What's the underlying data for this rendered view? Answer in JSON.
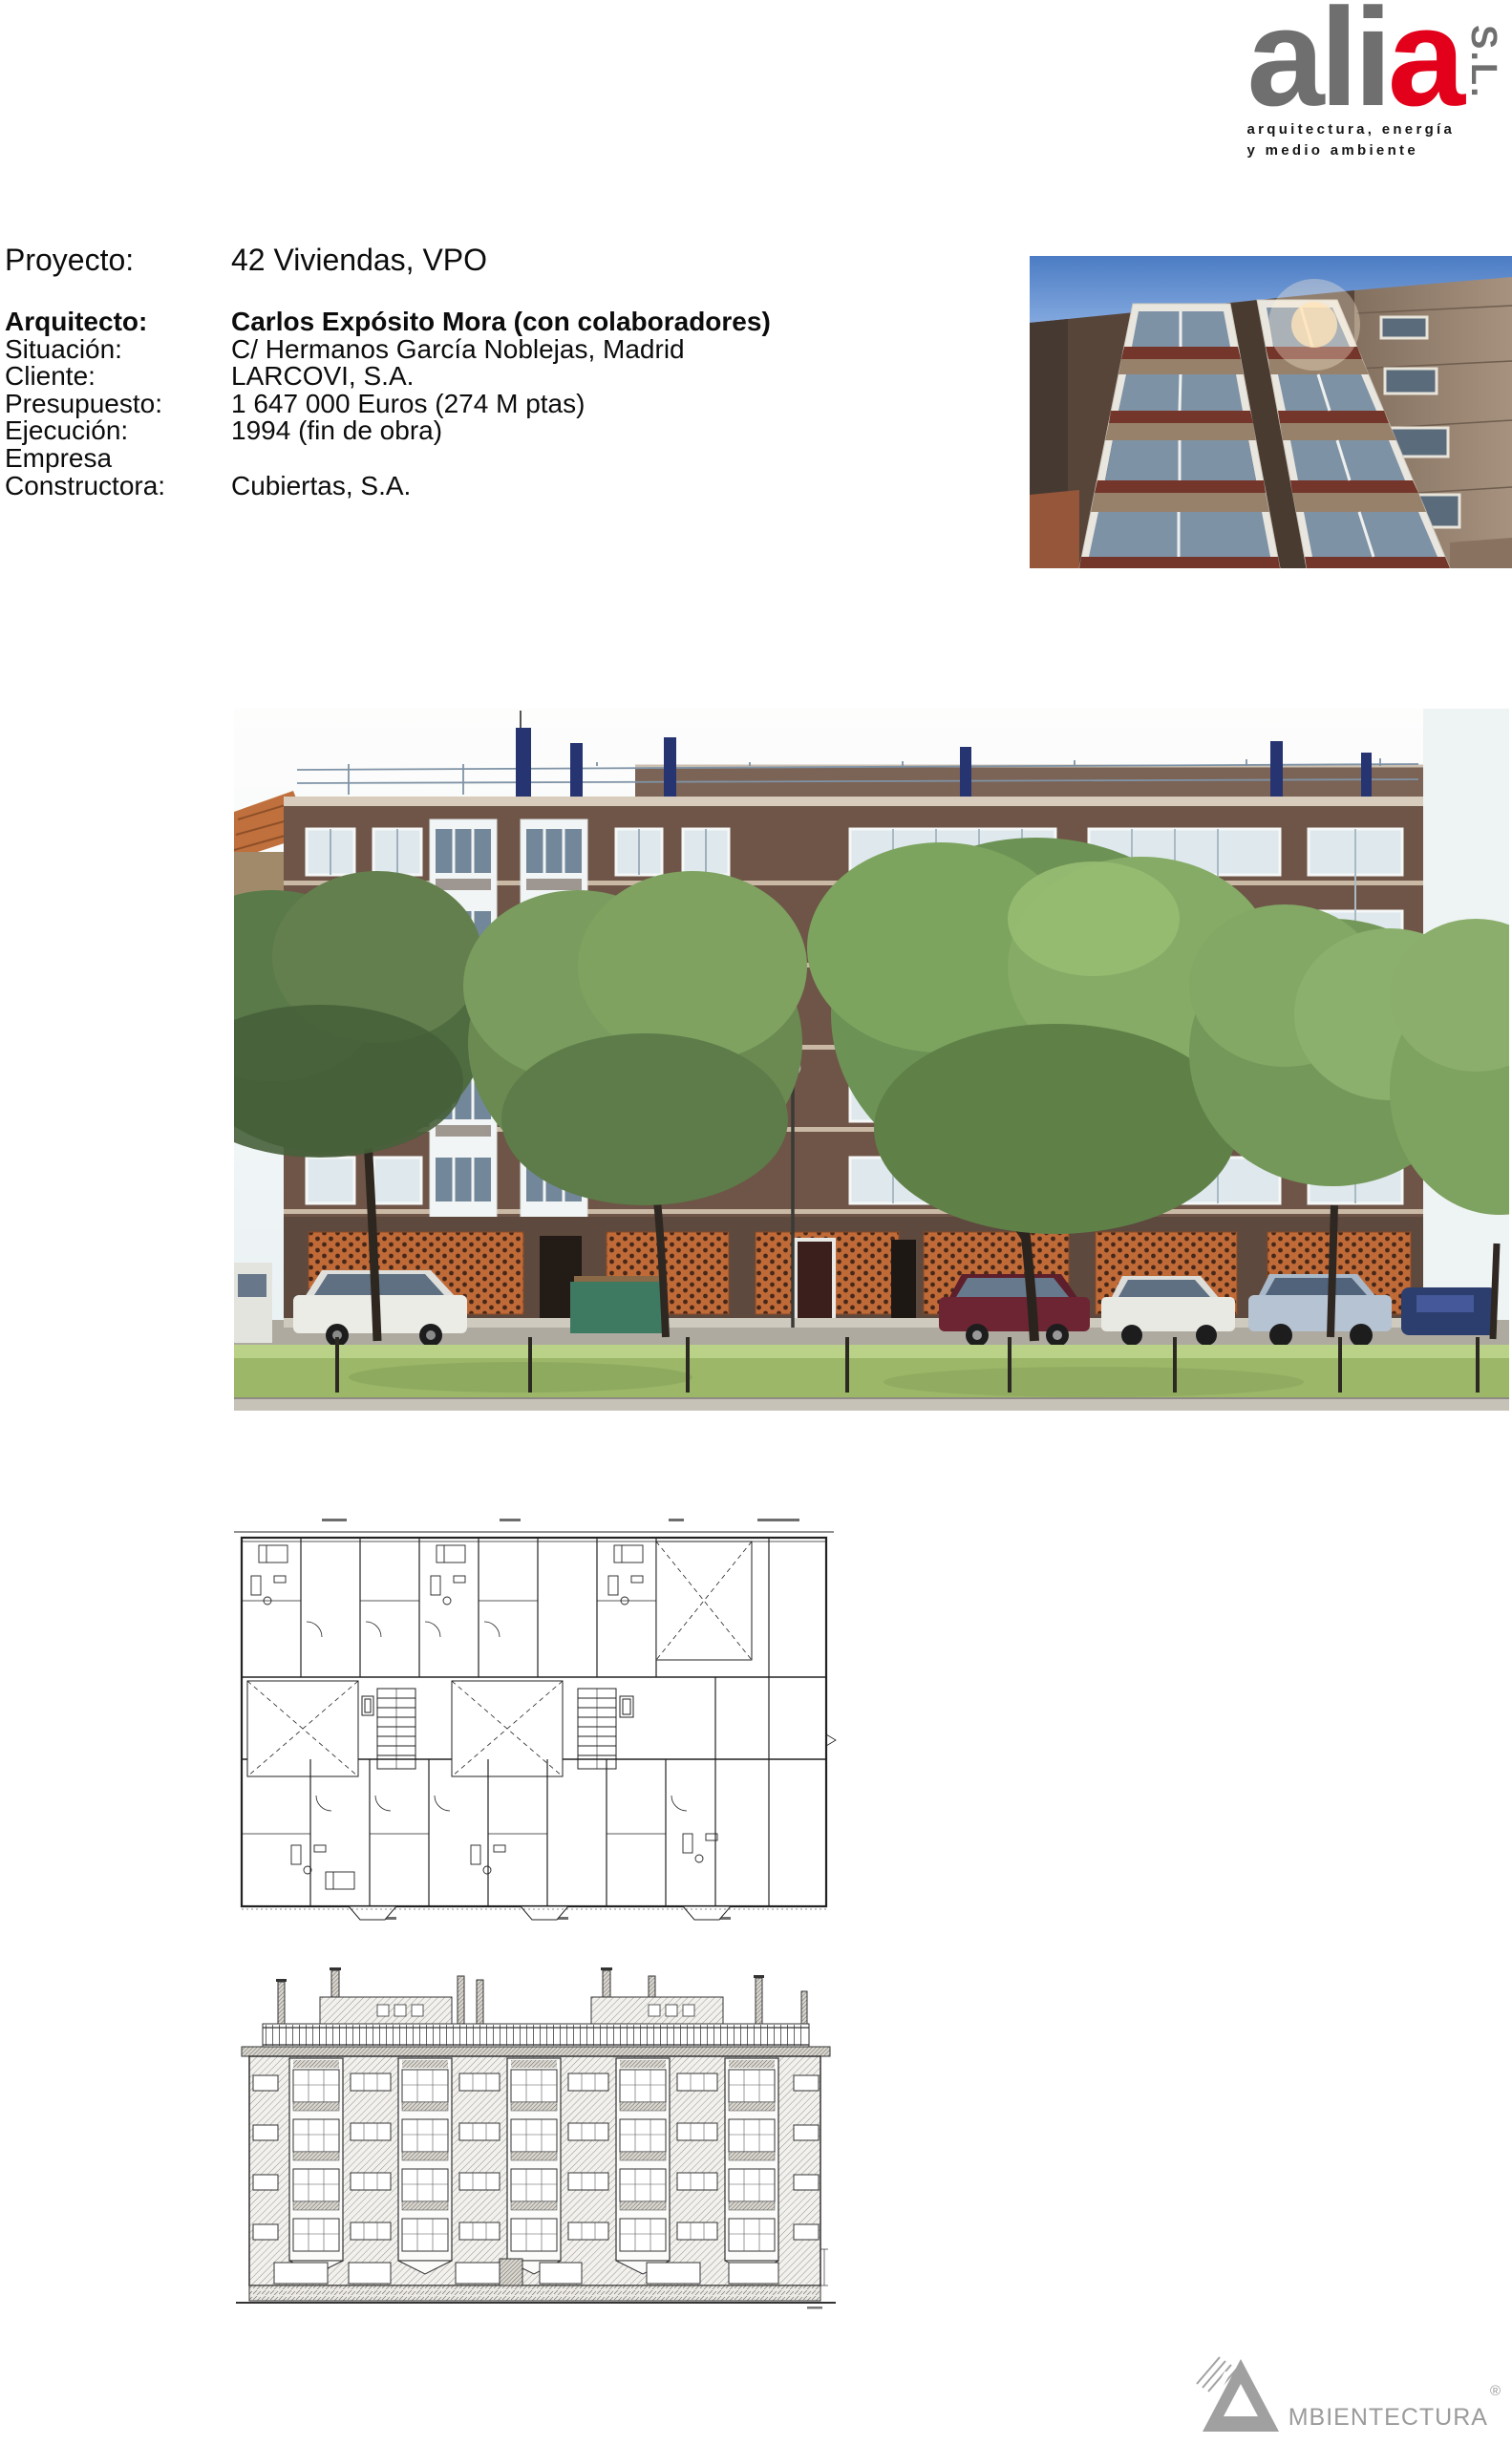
{
  "page": {
    "background": "#ffffff"
  },
  "logo": {
    "name_gray": "ali",
    "name_red": "a",
    "suffix": "S.L.",
    "tagline_line1": "arquitectura, energía",
    "tagline_line2": "y medio ambiente",
    "gray": "#6f6f6f",
    "red": "#e2001a"
  },
  "project": {
    "title_label": "Proyecto:",
    "title_value": "42 Viviendas, VPO",
    "rows": [
      {
        "label": "Arquitecto:",
        "value": "Carlos Expósito Mora (con colaboradores)"
      },
      {
        "label": "Situación:",
        "value": "C/ Hermanos García Noblejas, Madrid"
      },
      {
        "label": "Cliente:",
        "value": "LARCOVI, S.A."
      },
      {
        "label": "Presupuesto:",
        "value": "1 647 000 Euros (274 M ptas)"
      },
      {
        "label": "Ejecución:",
        "value": "1994 (fin de obra)"
      },
      {
        "label": "Empresa",
        "value": ""
      },
      {
        "label": "Constructora:",
        "value": "Cubiertas, S.A."
      }
    ]
  },
  "footer_logo": {
    "text": "MBIENTECTURA",
    "registered": "®",
    "gray": "#9b9b9b"
  }
}
